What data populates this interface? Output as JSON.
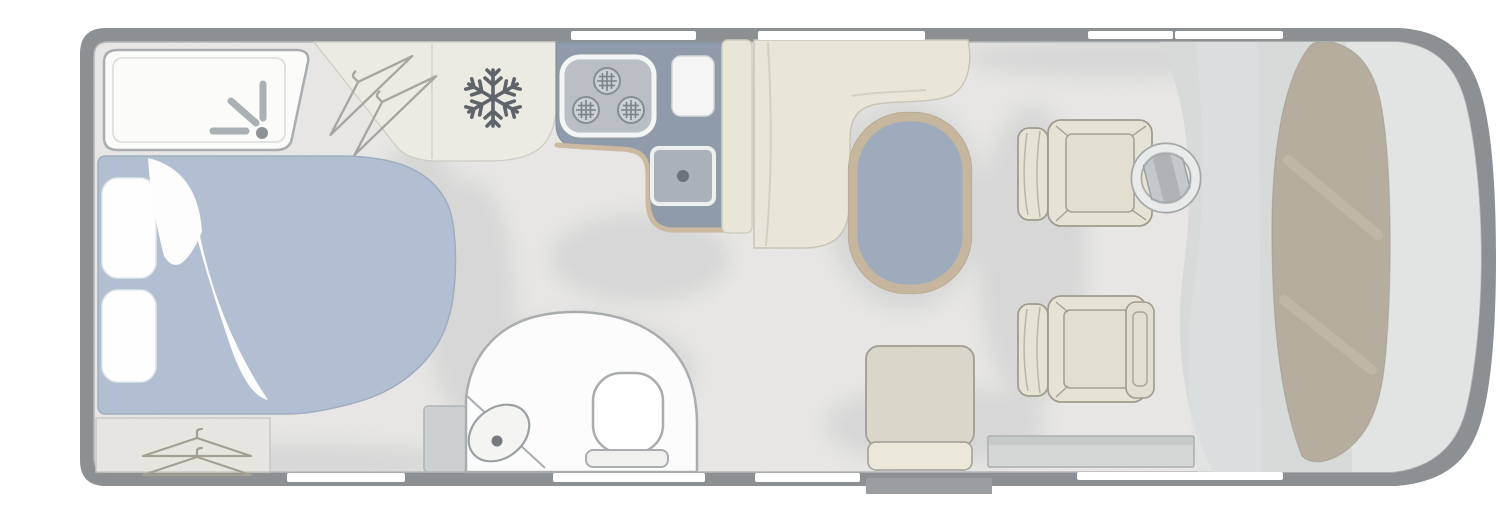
{
  "page": {
    "title_hidden": "",
    "background": "#ffffff"
  },
  "diagram": {
    "kind": "motorhome-floorplan",
    "orientation": "cab-on-right",
    "rooms": [
      {
        "name": "rear-shower"
      },
      {
        "name": "rear-bedroom"
      },
      {
        "name": "kitchen"
      },
      {
        "name": "washroom"
      },
      {
        "name": "dinette-lounge"
      },
      {
        "name": "cab"
      }
    ],
    "fixtures": [
      {
        "name": "shower-tray",
        "icon": "shower-spray-icon"
      },
      {
        "name": "double-bed",
        "icon": "bed-with-two-pillows"
      },
      {
        "name": "rear-wardrobe",
        "icon": "clothes-hanger-icon"
      },
      {
        "name": "top-wardrobe",
        "icon": "clothes-hanger-icon"
      },
      {
        "name": "fridge",
        "icon": "snowflake-icon"
      },
      {
        "name": "hob",
        "icon": "three-burner-hob-icon"
      },
      {
        "name": "worktop-board",
        "icon": "board"
      },
      {
        "name": "sink",
        "icon": "drain-dot-icon"
      },
      {
        "name": "dinette-bench",
        "icon": "l-bench"
      },
      {
        "name": "dinette-table",
        "icon": "oval-table"
      },
      {
        "name": "toilet",
        "icon": "toilet-icon"
      },
      {
        "name": "basin",
        "icon": "basin-drain-icon"
      },
      {
        "name": "travel-seat",
        "icon": "belted-seat"
      },
      {
        "name": "driver-swivel-seat",
        "icon": "cab-seat"
      },
      {
        "name": "passenger-swivel-seat",
        "icon": "cab-seat"
      },
      {
        "name": "steering-wheel",
        "icon": "steering-wheel-icon"
      },
      {
        "name": "sideboard",
        "icon": "low-cabinet"
      },
      {
        "name": "entry-step",
        "icon": "door-step"
      },
      {
        "name": "windows",
        "count_top": 4,
        "count_bottom": 4
      }
    ]
  },
  "colors": {
    "wall": "#8c9093",
    "floor": "#eae9e7",
    "cab_floor": "#d7dad9",
    "nose_floor": "#e2e4e3",
    "entry_band": "#dde1e0",
    "dashboard": "#b5ad9d",
    "window": "#ffffff",
    "bed": "#b2bfd2",
    "bed_edge": "#9fadc2",
    "pillow": "#fefefe",
    "duvet": "#fdfdfd",
    "counter": "#8f9aaa",
    "counter_trim": "#cbb9a0",
    "sink": "#aab1b8",
    "hob": "#b9bfc4",
    "burner": "#ccd1d4",
    "fridge": "#ecebe3",
    "bench": "#e9e6d9",
    "panel": "#e9e6d8",
    "table_top": "#9dabbd",
    "table_edge": "#c6b69d",
    "seat": "#e6e3d4",
    "seat_back": "#dad7ca",
    "cushion": "#ebe8da",
    "white_fixture": "#fcfcfc",
    "fixture_line": "#a9adaf",
    "icon_line": "#aab0b3",
    "snowflake": "#5f646a",
    "hanger": "#a39f93",
    "wardrobe": "#e6e5e0",
    "sideboard": "#d4d7d6",
    "step": "#9b9ea1",
    "wheel_ring": "#e9ebea",
    "column": "#c3c8ca",
    "shadow": "#c5c8c8"
  }
}
